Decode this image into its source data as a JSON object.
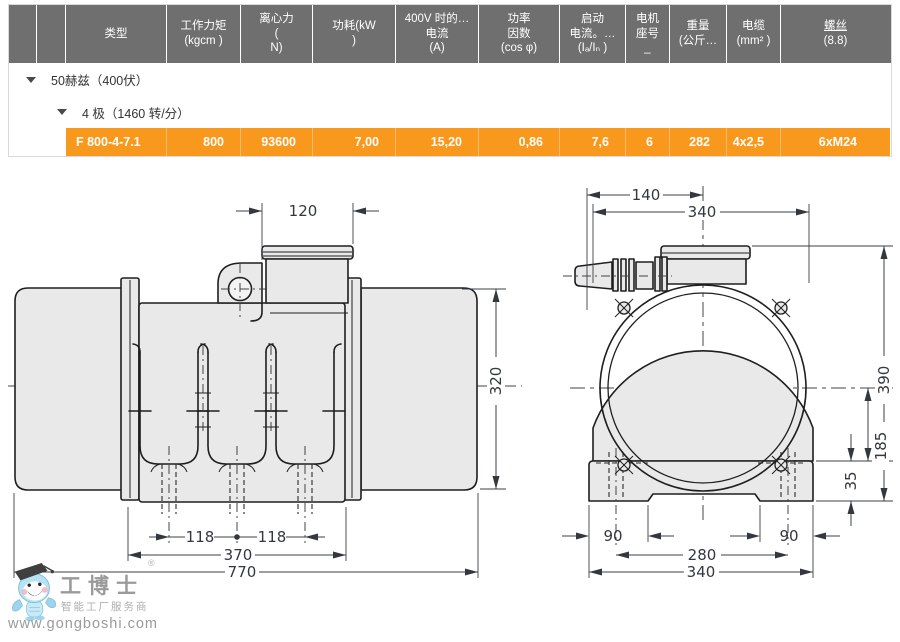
{
  "colors": {
    "header_bg": "#6F6F6F",
    "highlight_row": "#F8991D",
    "drawing_fill": "#E9E9E9",
    "line": "#1F1F1F"
  },
  "table": {
    "header": {
      "cells": [
        {
          "title": "",
          "sub": ""
        },
        {
          "title": "",
          "sub": ""
        },
        {
          "title": "类型",
          "sub": ""
        },
        {
          "title": "工作力矩",
          "sub": "(kgcm )"
        },
        {
          "title": "离心力",
          "sub": "(\nN)"
        },
        {
          "title": "功耗(kW",
          "sub": ")"
        },
        {
          "title": "400V 时的…",
          "sub": "电流\n(A)"
        },
        {
          "title": "功率",
          "sub": "因数\n(cos φ)"
        },
        {
          "title": "启动",
          "sub": "电流。…\n(Iₐ/Iₙ )"
        },
        {
          "title": "电机",
          "sub": "座号\n_"
        },
        {
          "title": "重量",
          "sub": "(公斤…"
        },
        {
          "title": "电缆",
          "sub": "(mm² )"
        },
        {
          "title": "螺丝",
          "sub": "(8.8)"
        }
      ]
    },
    "groups": {
      "frequency": "50赫兹（400伏）",
      "poles": "4 极（1460 转/分）"
    },
    "row": {
      "values": [
        "F 800-4-7.1",
        "800",
        "93600",
        "7,00",
        "15,20",
        "0,86",
        "7,6",
        "6",
        "282",
        "4x2,5",
        "6xM24"
      ]
    }
  },
  "drawing": {
    "side": {
      "box_width": "120",
      "height": "320",
      "hole_left": "118",
      "hole_right": "118",
      "body_width": "370",
      "total_width": "770"
    },
    "front": {
      "gland_offset": "140",
      "top_width": "340",
      "height": "390",
      "center_to_base": "185",
      "base_height": "35",
      "foot_left": "90",
      "slot_width": "280",
      "base_width": "340",
      "foot_right": "90"
    }
  },
  "logo": {
    "brand": "工博士",
    "registered": "®",
    "tagline": "智能工厂服务商",
    "url": "www.gongboshi.com"
  }
}
